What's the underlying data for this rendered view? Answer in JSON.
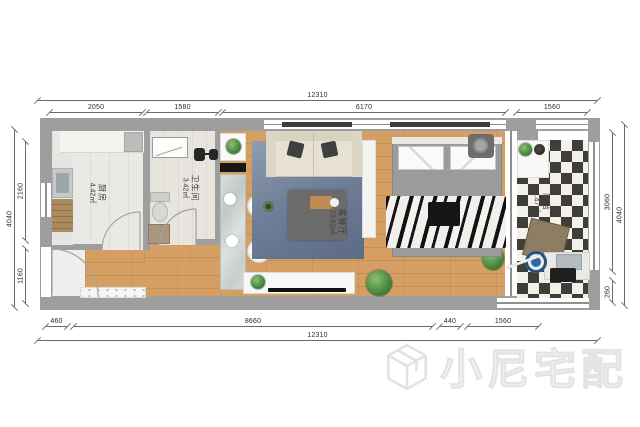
{
  "watermark": {
    "brand": "小尼宅配"
  },
  "rooms": {
    "kitchen": {
      "name": "厨房",
      "area": "4.42㎡"
    },
    "bathroom": {
      "name": "卫生间",
      "area": "3.42㎡"
    },
    "living_dining": {
      "name": "客餐厅",
      "area": "23.62㎡"
    },
    "balcony": {
      "name": "阳台",
      "area": "4.47㎡"
    }
  },
  "dimensions": {
    "top_total": "12310",
    "top_segments": [
      "2050",
      "1580",
      "6170",
      "1560"
    ],
    "bottom_segments": [
      "460",
      "8660",
      "440",
      "1560"
    ],
    "bottom_total": "12310",
    "left_total": "4040",
    "left_segments": [
      "2160",
      "1160"
    ],
    "right_segments": [
      "3060",
      "260"
    ],
    "right_total": "4040"
  },
  "colors": {
    "wall": "#9e9e9e",
    "wood_floor": "#d49a5e",
    "rug": "#71809a",
    "checker_dark": "#403e39",
    "dim_line": "#6a6a6a"
  }
}
